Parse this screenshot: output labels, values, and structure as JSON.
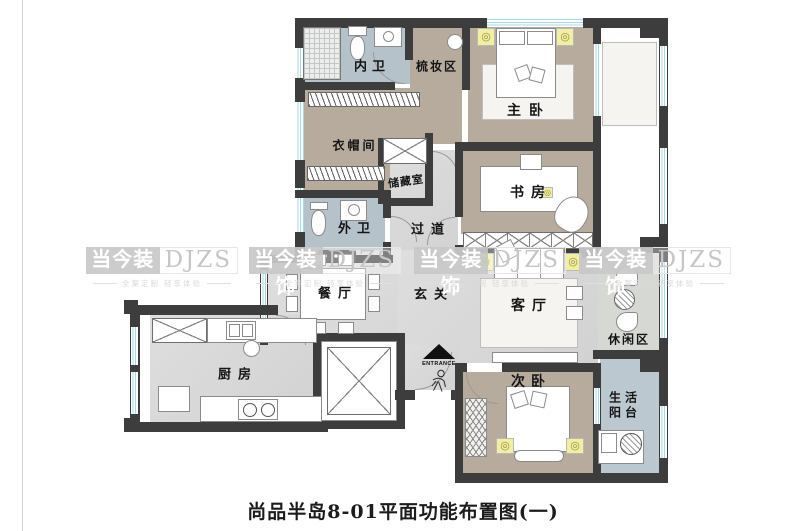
{
  "title": {
    "text": "尚品半岛8-01平面功能布置图(一)"
  },
  "watermark": {
    "brand": "当今装饰",
    "initials": "DJZS",
    "tagline": "全案定制 轻享体验"
  },
  "entrance": {
    "label": "ENTRANCE"
  },
  "icons": {
    "lamp_glyph": "◎"
  },
  "rooms": {
    "neiwei": {
      "label": "内卫"
    },
    "shuzhuang": {
      "label": "梳妆区"
    },
    "zhuwo": {
      "label": "主卧"
    },
    "yimaojian": {
      "label": "衣帽间"
    },
    "chucang": {
      "label": "储藏室"
    },
    "waiwei": {
      "label": "外卫"
    },
    "guodao": {
      "label": "过道"
    },
    "shufang": {
      "label": "书房"
    },
    "canting": {
      "label": "餐厅"
    },
    "xuanguan": {
      "label": "玄关"
    },
    "keting": {
      "label": "客厅"
    },
    "xiuxian": {
      "label": "休闲区"
    },
    "chufang": {
      "label": "厨房"
    },
    "ciwo": {
      "label": "次卧"
    },
    "yangtai": {
      "label": "生活阳台",
      "line1": "生活",
      "line2": "阳台"
    }
  },
  "colors": {
    "wall": "#3d3d3d",
    "floor_tan": "#b7ab9e",
    "floor_bath": "#b6c2ca",
    "floor_gray": "#d9d9d9",
    "floor_balcony": "#bcc8d0",
    "window_blue": "#a5d8e6",
    "lamp_yellow": "#f2f0a0"
  }
}
